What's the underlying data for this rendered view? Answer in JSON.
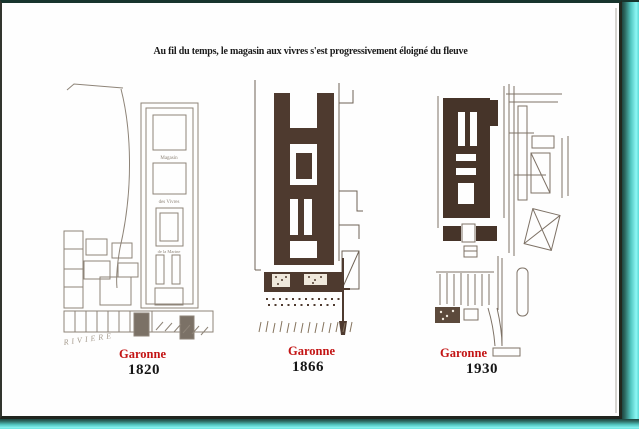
{
  "title": "Au fil du temps, le magasin aux vivres s'est progressivement éloigné du fleuve",
  "colors": {
    "caption_red": "#c31414",
    "year_black": "#161616",
    "page_white": "#fefefe",
    "edge_cyan": "#8df7f4",
    "frame_dark": "#17352d",
    "ink_dark_1866": "#4e3a2f",
    "ink_dark_1930": "#463429",
    "sketch_gray_1820": "#8e8478"
  },
  "figures": [
    {
      "caption_river": "Garonne",
      "caption_year": "1820",
      "labels": {
        "riviere": "RIVIERE",
        "block1": "Magasin",
        "block2": "des Vivres",
        "block3": "de la Marine"
      }
    },
    {
      "caption_river": "Garonne",
      "caption_year": "1866"
    },
    {
      "caption_river": "Garonne",
      "caption_year": "1930"
    }
  ]
}
